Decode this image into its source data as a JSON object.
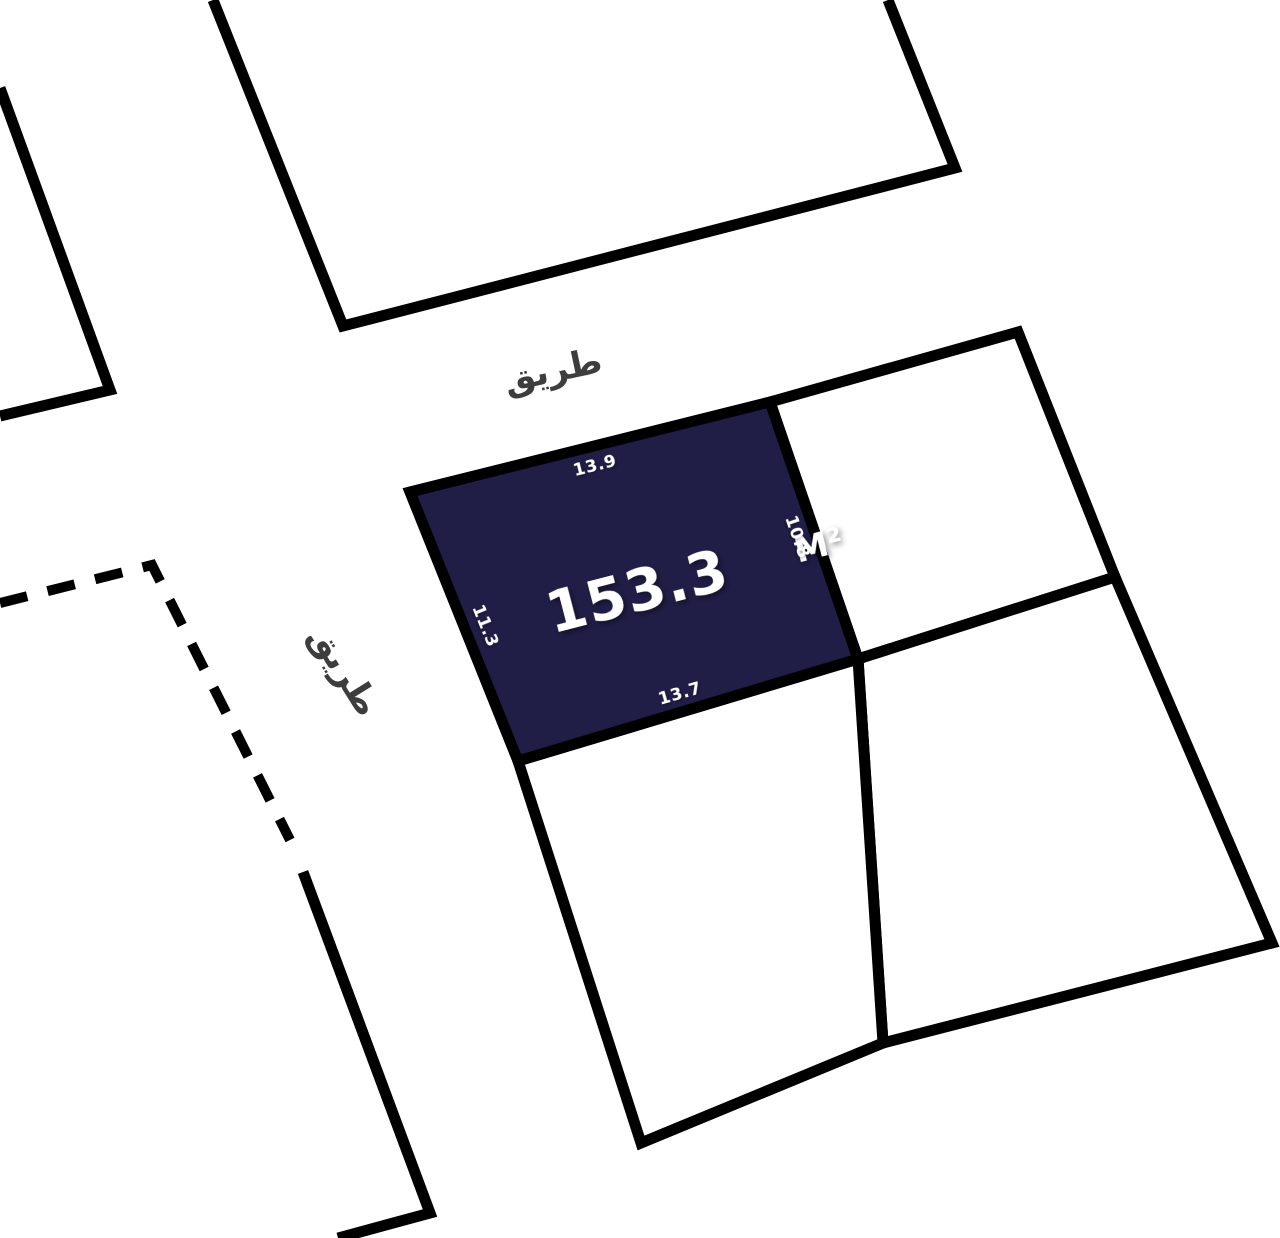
{
  "map": {
    "streets": {
      "top": "طريق",
      "left": "طريق"
    },
    "highlighted_parcel": {
      "area": "153.3",
      "area_unit": "M²",
      "side_top": "13.9",
      "side_right": "10.8",
      "side_left": "11.3",
      "side_bottom": "13.7",
      "fill_color": "#201E47"
    },
    "colors": {
      "boundary_line": "#000000",
      "street_label": "#3D3D3D",
      "dimension_label": "#FFFFFF",
      "background": "#FFFFFF"
    }
  }
}
